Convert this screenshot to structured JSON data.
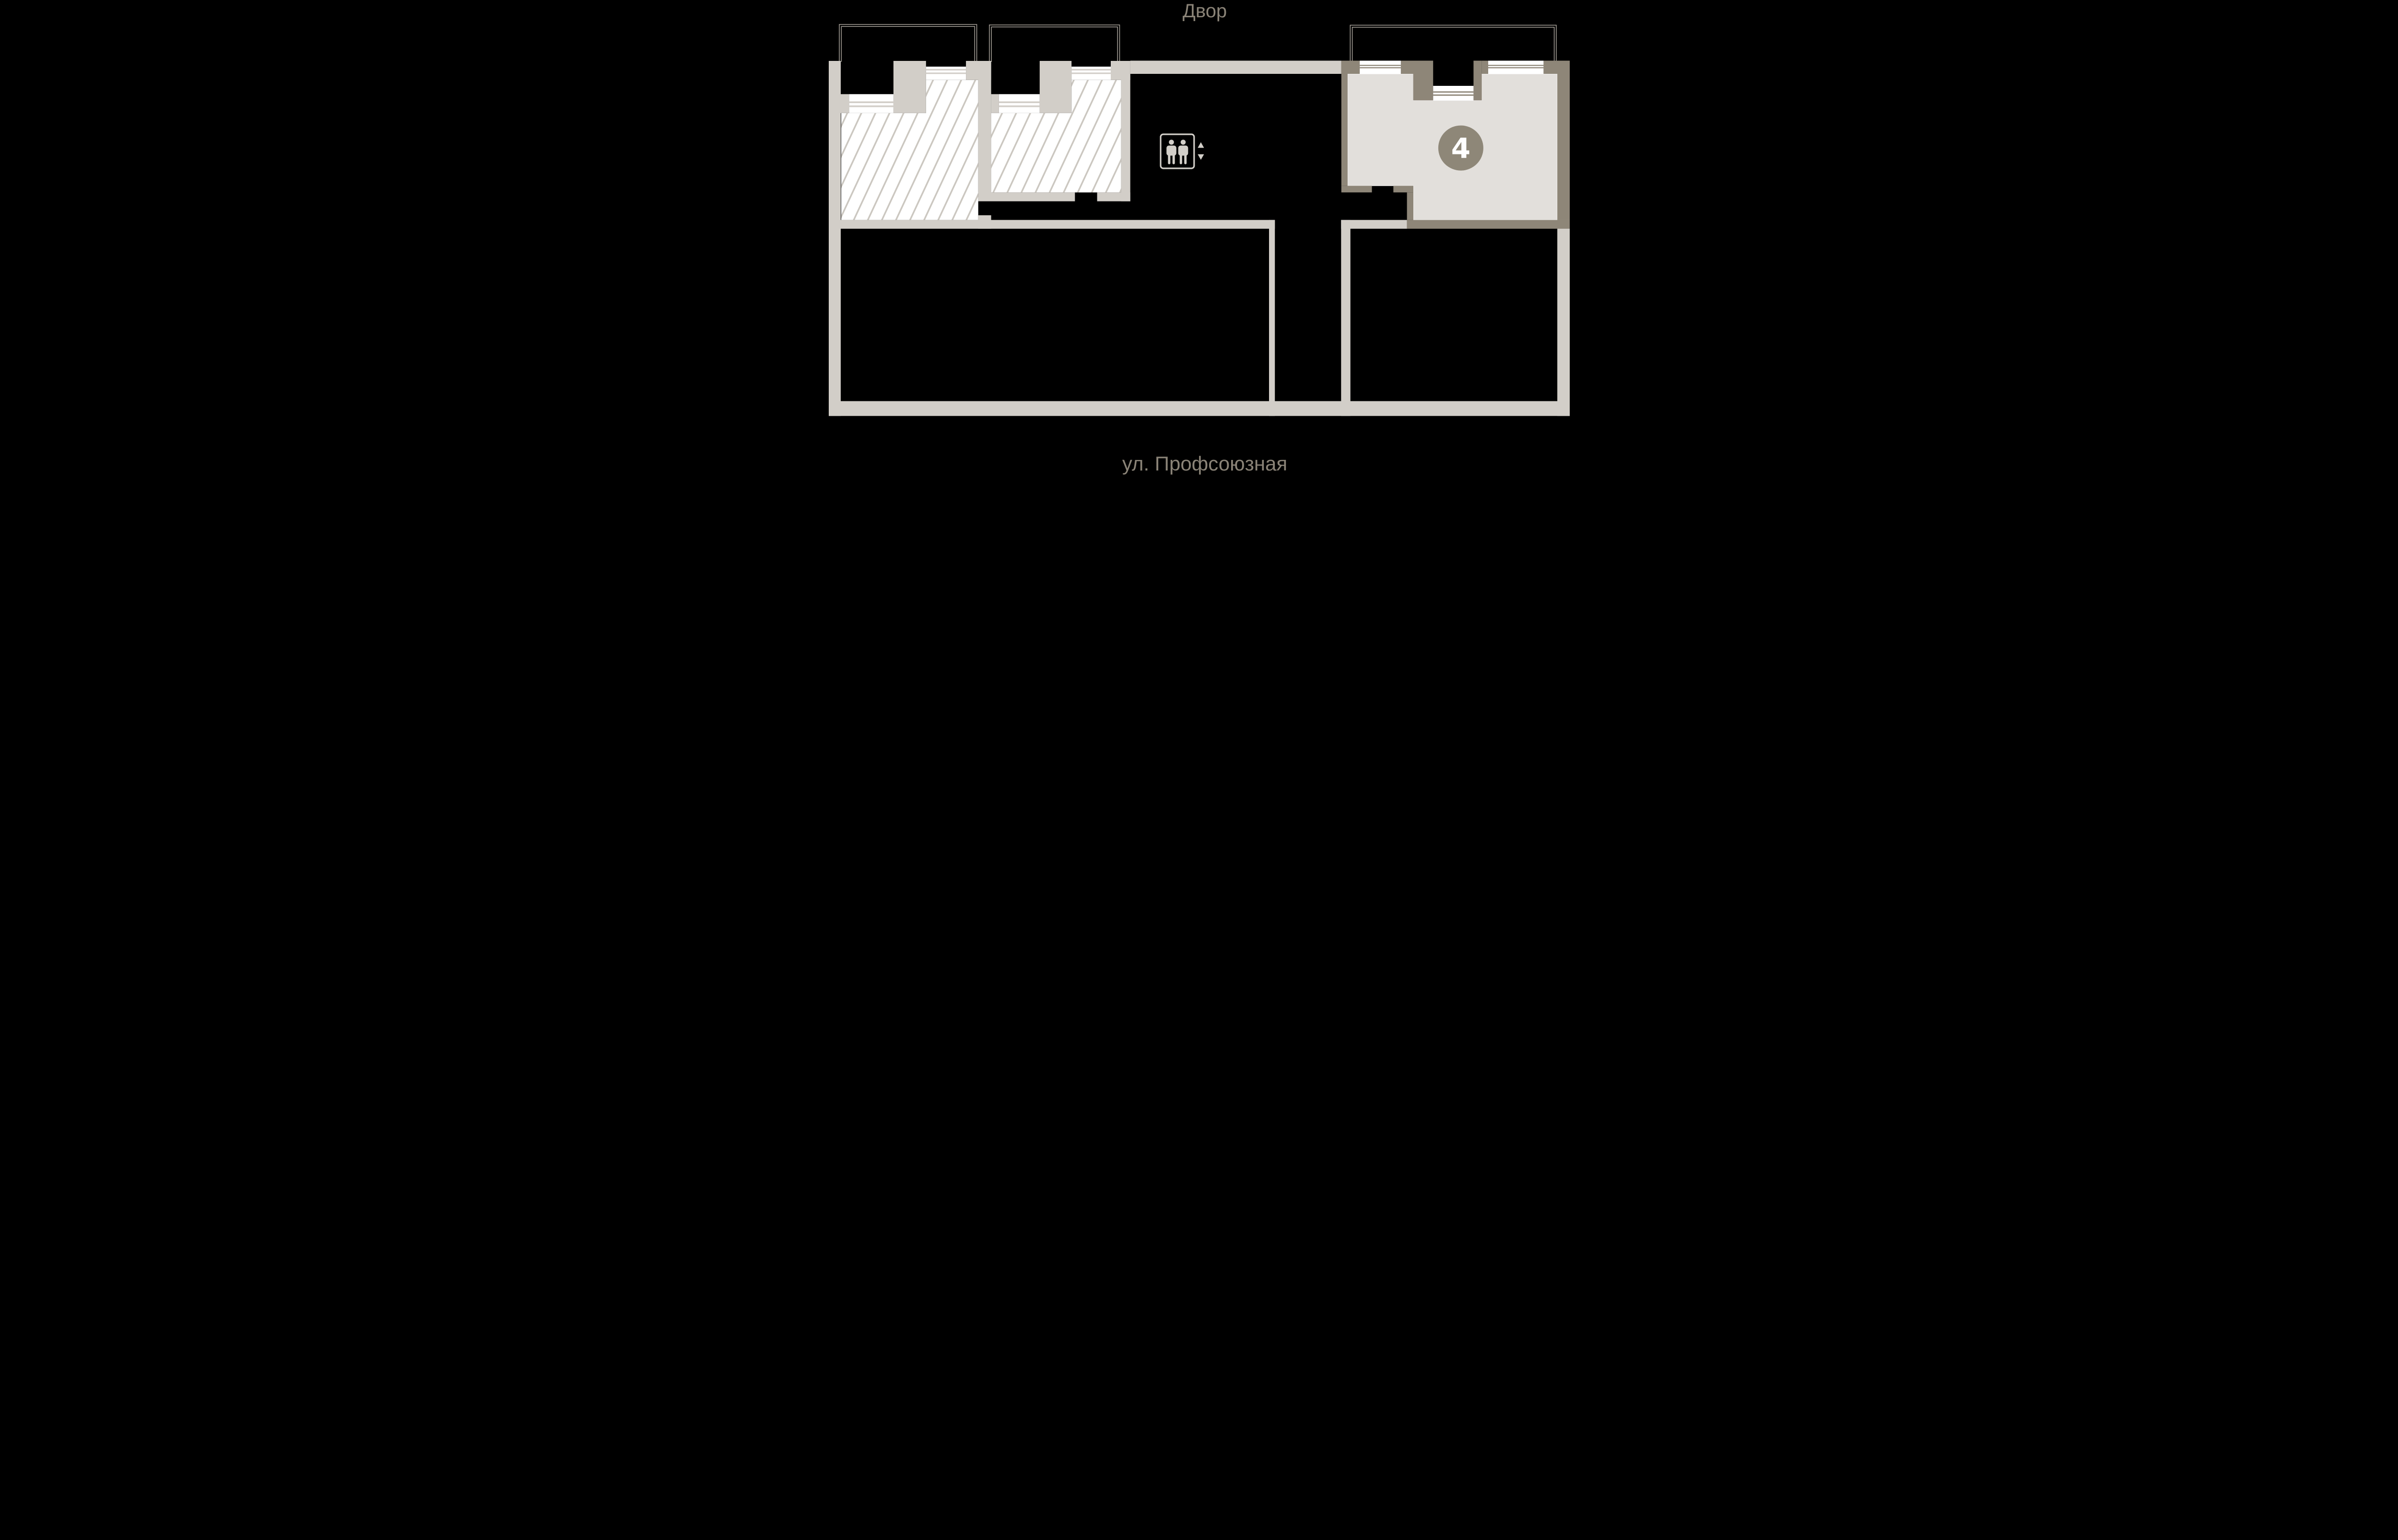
{
  "scene": {
    "description": "Residential floor plan for apartment selection, black background",
    "background": "#000000"
  },
  "labels": {
    "top_street": "Двор",
    "bottom_street": "ул. Профсоюзная"
  },
  "apartment": {
    "number": "4",
    "state": "highlighted-available",
    "fill": "#e2dfdb",
    "border": "#8e8678",
    "badge_color": "#8e8778"
  },
  "hatched_units": {
    "count": 2,
    "state": "unavailable",
    "hatch_line_color": "#cbc7c0"
  },
  "icons": {
    "elevator": "elevator-icon",
    "elevator_arrows": "up-down-arrows-icon"
  },
  "colors": {
    "c-bg": "#000000",
    "c-wall": "#d2cec8",
    "c-hatch": "#cbc7c0",
    "c-win": "#ffffff",
    "c-balcony": "#a9a39b",
    "c-icon": "#d3cfc9",
    "c-text": "#8a8377",
    "c-apt4-fill": "#e2dfdb",
    "c-apt4-border": "#8e8678",
    "c-badge": "#8e8778"
  }
}
